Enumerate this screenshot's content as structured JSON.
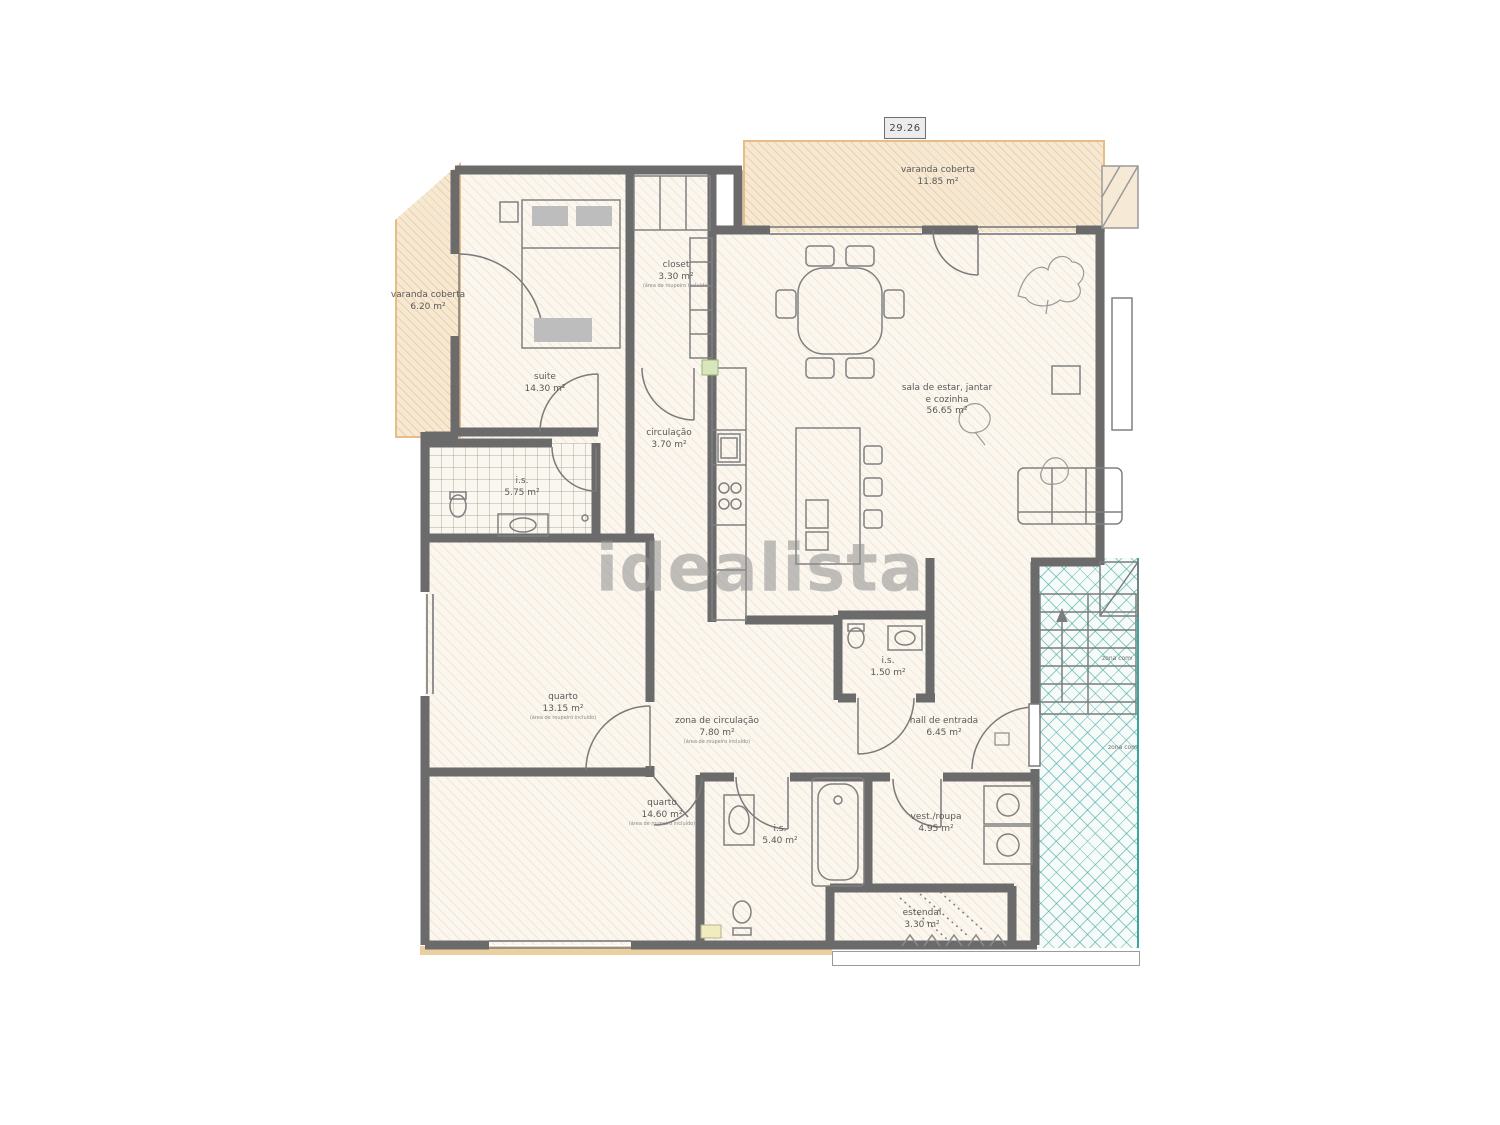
{
  "watermark": "idealista",
  "plan": {
    "dimension": "29.26",
    "labels": {
      "varanda_left": {
        "name": "varanda coberta",
        "area": "6.20 m²"
      },
      "varanda_top": {
        "name": "varanda coberta",
        "area": "11.85 m²"
      },
      "suite": {
        "name": "suite",
        "area": "14.30 m²"
      },
      "closet": {
        "name": "closet",
        "area": "3.30 m²",
        "note": "(área de roupeiro incluído)"
      },
      "circulacao": {
        "name": "circulação",
        "area": "3.70 m²"
      },
      "is_suite": {
        "name": "i.s.",
        "area": "5.75 m²"
      },
      "sala": {
        "name": "sala de estar, jantar",
        "name2": "e cozinha",
        "area": "56.65 m²"
      },
      "quarto1": {
        "name": "quarto",
        "area": "13.15 m²",
        "note": "(área de roupeiro incluído)"
      },
      "zona_circulacao": {
        "name": "zona de circulação",
        "area": "7.80 m²",
        "note": "(área de roupeiro incluído)"
      },
      "is_small": {
        "name": "i.s.",
        "area": "1.50 m²"
      },
      "hall": {
        "name": "hall de entrada",
        "area": "6.45 m²"
      },
      "quarto2": {
        "name": "quarto",
        "area": "14.60 m²",
        "note": "(área de roupeiro incluído)"
      },
      "is_main": {
        "name": "i.s.",
        "area": "5.40 m²"
      },
      "vest": {
        "name": "vest./roupa",
        "area": "4.95 m²"
      },
      "estendal": {
        "name": "estendal",
        "area": "3.30 m²"
      },
      "zona_comum_1": {
        "name": "zona comum"
      },
      "zona_comum_2": {
        "name": "zona comum"
      }
    },
    "colors": {
      "wall": "#6b6b6b",
      "deck_fill": "#f6e9d3",
      "deck_border": "#e7bd85",
      "teal": "#3aa69e",
      "floor": "#fbf6ee",
      "watermark_gray": "#8f8f8f"
    }
  }
}
